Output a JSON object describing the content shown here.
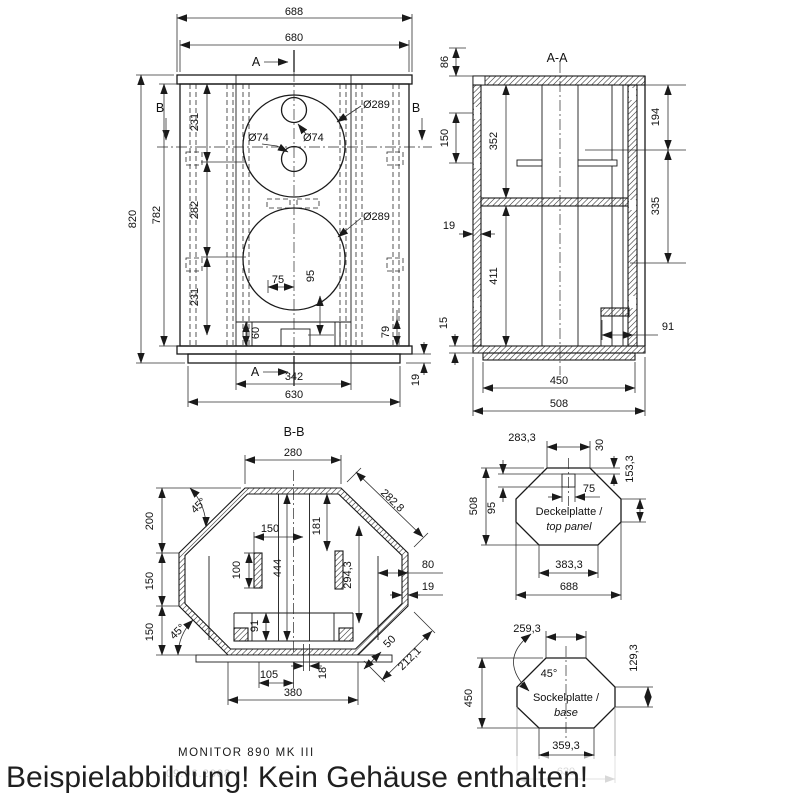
{
  "drawing": {
    "style": {
      "line_color": "#1a1a1a",
      "dim_color": "#2f2f2f",
      "faded_color": "#9a9a9a",
      "background": "#ffffff"
    }
  },
  "front_view": {
    "section_a": "A",
    "section_b": "B",
    "dims": {
      "overall_width": "688",
      "body_width": "680",
      "overall_height": "820",
      "front_height": "782",
      "upper_section": "231",
      "mid_section": "282",
      "lower_section": "231",
      "woofer_upper": "Ø289",
      "woofer_lower": "Ø289",
      "port_left": "Ø74",
      "port_right": "Ø74",
      "port_offset_h": "75",
      "port_offset_v": "95",
      "brace_height": "60",
      "recess_height": "79",
      "plinth_height": "19",
      "baffle_width": "342",
      "plinth_width": "630"
    }
  },
  "section_aa": {
    "title": "A-A",
    "dims": {
      "cap_overhang": "86",
      "side_offset": "150",
      "upper_chamber": "352",
      "wall_thickness": "19",
      "base_step": "15",
      "lower_chamber": "411",
      "right_upper": "194",
      "right_mid": "335",
      "terminal_width": "91",
      "plinth_depth": "450",
      "overall_depth": "508"
    }
  },
  "section_bb": {
    "title": "B-B",
    "dims": {
      "front_width": "280",
      "facet_length": "282,8",
      "top_angle": "45°",
      "bottom_angle": "45°",
      "front_section": "200",
      "side_section": "150",
      "rear_section": "150",
      "brace_offset": "150",
      "brace_length": "100",
      "brace_depth": "181",
      "center_brace": "444",
      "rear_brace": "294,3",
      "side_inner": "80",
      "wall_thickness": "19",
      "duct_height": "91",
      "duct_offset": "105",
      "board_thickness": "18",
      "rear_width": "380",
      "facet_inner": "50",
      "facet_outer": "212,1"
    }
  },
  "top_panel": {
    "label_de": "Deckelplatte /",
    "label_en": "top panel",
    "dims": {
      "front_edge": "283,3",
      "hole_inset": "30",
      "side_edge": "153,3",
      "depth": "508",
      "hole_height": "95",
      "hole_width": "75",
      "rear_edge": "383,3",
      "overall_width": "688"
    }
  },
  "base_panel": {
    "label_de": "Sockelplatte /",
    "label_en": "base",
    "dims": {
      "front_edge": "259,3",
      "corner_angle": "45°",
      "side_edge": "129,3",
      "depth": "450",
      "rear_edge": "359,3",
      "overall_width": "630"
    }
  },
  "footer": {
    "title": "MONITOR 890 MK III",
    "date": "09.06.2008"
  },
  "watermark": {
    "text": "Beispielabbildung! Kein Gehäuse enthalten!"
  }
}
